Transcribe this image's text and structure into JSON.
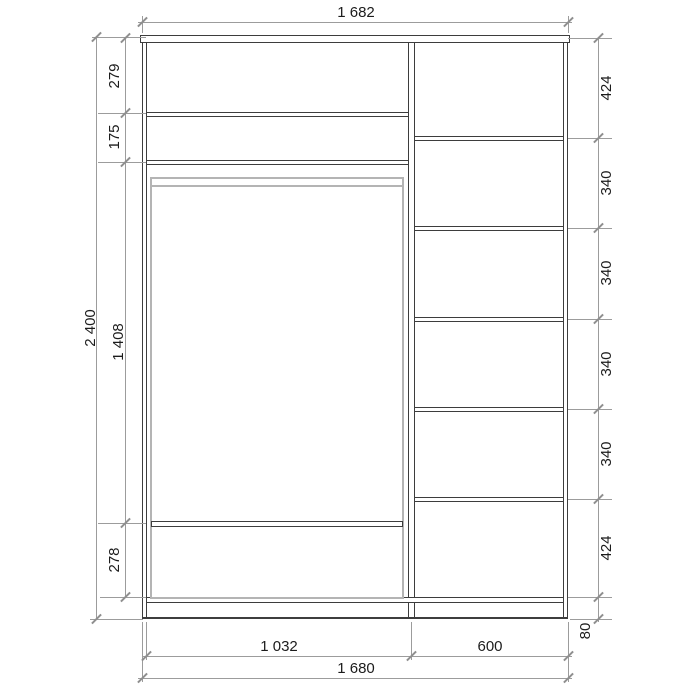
{
  "colors": {
    "background": "#ffffff",
    "cabinet_line": "#3d3d3d",
    "door_outline": "#b4b4b4",
    "dimension_line": "#9c9c9c",
    "text": "#1c1c1c"
  },
  "dims": {
    "top_width": "1 682",
    "height_total": "2 400",
    "left": [
      "279",
      "175",
      "1 408",
      "278"
    ],
    "right": [
      "424",
      "340",
      "340",
      "340",
      "340",
      "424",
      "80"
    ],
    "bottom_left": "1 032",
    "bottom_right": "600",
    "bottom_total": "1 680"
  }
}
